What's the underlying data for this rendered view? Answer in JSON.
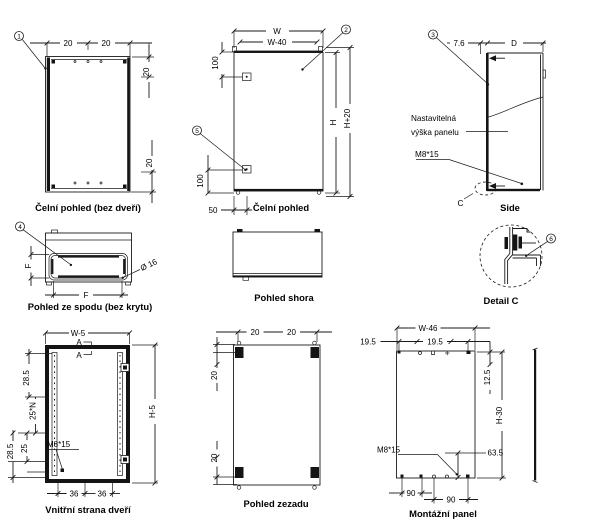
{
  "drawing": {
    "type": "enclosure technical drawing",
    "language": "Czech"
  },
  "colors": {
    "line": "#1a1a1a",
    "background": "#ffffff"
  },
  "balloons": {
    "b1": "1",
    "b2": "2",
    "b3": "3",
    "b4": "4",
    "b5": "5",
    "b6": "6"
  },
  "views": {
    "front_no_door": {
      "title": "Čelní pohled (bez dveří)",
      "dim_top_left": "20",
      "dim_top_right": "20",
      "dim_right_upper": "20",
      "dim_right_lower": "20"
    },
    "front": {
      "title": "Čelní pohled",
      "dim_w": "W",
      "dim_w40": "W-40",
      "dim_100_top": "100",
      "dim_100_bottom": "100",
      "dim_50": "50",
      "dim_h": "H",
      "dim_h20": "H+20"
    },
    "side": {
      "title": "Side",
      "dim_76": "7.6",
      "dim_d": "D",
      "label_adj1": "Nastavitelná",
      "label_adj2": "výška panelu",
      "label_bolt": "M8*15",
      "label_c": "C"
    },
    "bottom": {
      "title": "Pohled ze spodu (bez krytu)",
      "dim_f_vert": "F",
      "dim_f_horiz": "F",
      "dim_dia": "Ø 16"
    },
    "top": {
      "title": "Pohled shora"
    },
    "detail_c": {
      "title": "Detail C"
    },
    "door_inner": {
      "title": "Vnitřní strana dveří",
      "dim_w5": "W-5",
      "dim_285_top": "28.5",
      "dim_25n": "25*N",
      "dim_25": "25",
      "dim_285_bottom": "28.5",
      "dim_h5": "H-5",
      "dim_36_left": "36",
      "dim_36_right": "36",
      "label_bolt": "M8*15",
      "label_a1": "A",
      "label_a2": "A"
    },
    "rear": {
      "title": "Pohled zezadu",
      "dim_top_left": "20",
      "dim_top_right": "20",
      "dim_left_upper": "20",
      "dim_left_lower": "20"
    },
    "mounting_panel": {
      "title": "Montážní panel",
      "dim_w46": "W-46",
      "dim_195_left": "19.5",
      "dim_195_right": "19.5",
      "dim_125": "12.5",
      "dim_h30": "H-30",
      "dim_635": "63.5",
      "dim_90_left": "90",
      "dim_90_right": "90",
      "label_bolt": "M8*15"
    }
  }
}
